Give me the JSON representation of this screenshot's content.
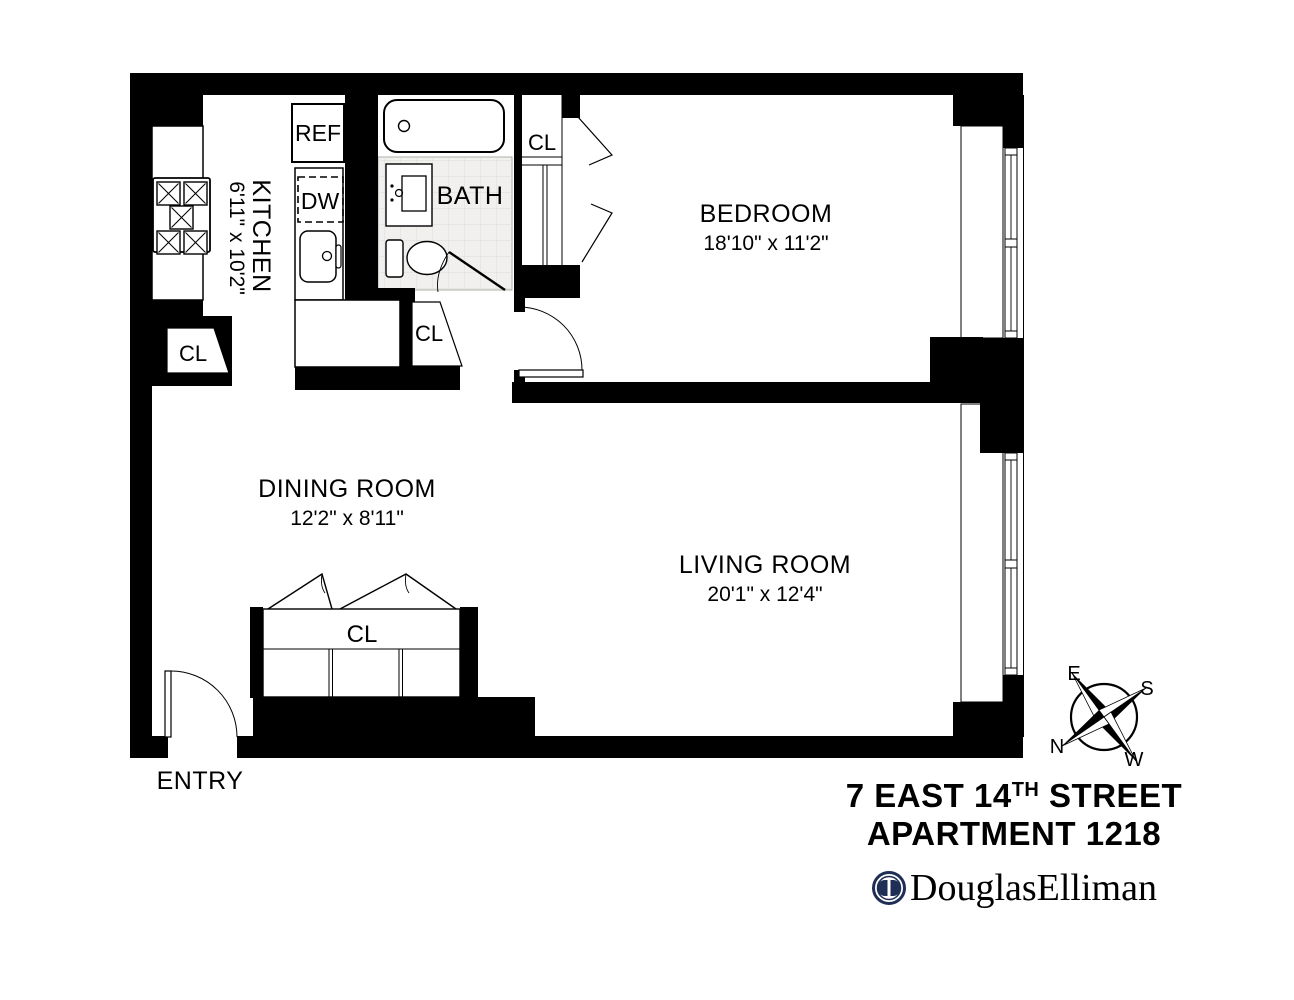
{
  "rooms": {
    "kitchen": {
      "name": "KITCHEN",
      "dims": "6'11\" x 10'2\""
    },
    "bedroom": {
      "name": "BEDROOM",
      "dims": "18'10\" x 11'2\""
    },
    "dining": {
      "name": "DINING ROOM",
      "dims": "12'2\" x 8'11\""
    },
    "living": {
      "name": "LIVING ROOM",
      "dims": "20'1\" x 12'4\""
    },
    "bath": {
      "name": "BATH"
    },
    "entry": {
      "name": "ENTRY"
    }
  },
  "labels": {
    "closet": "CL",
    "refrigerator": "REF",
    "dishwasher": "DW"
  },
  "compass": {
    "east": "E",
    "south": "S",
    "north": "N",
    "west": "W"
  },
  "footer": {
    "address_pre": "7 EAST 14",
    "address_sup": "TH",
    "address_post": " STREET",
    "apartment": "APARTMENT 1218",
    "brand": "DouglasElliman"
  },
  "colors": {
    "wall": "#000000",
    "brand_navy": "#1f2e55",
    "bath_tile": "#f1f0ee"
  }
}
